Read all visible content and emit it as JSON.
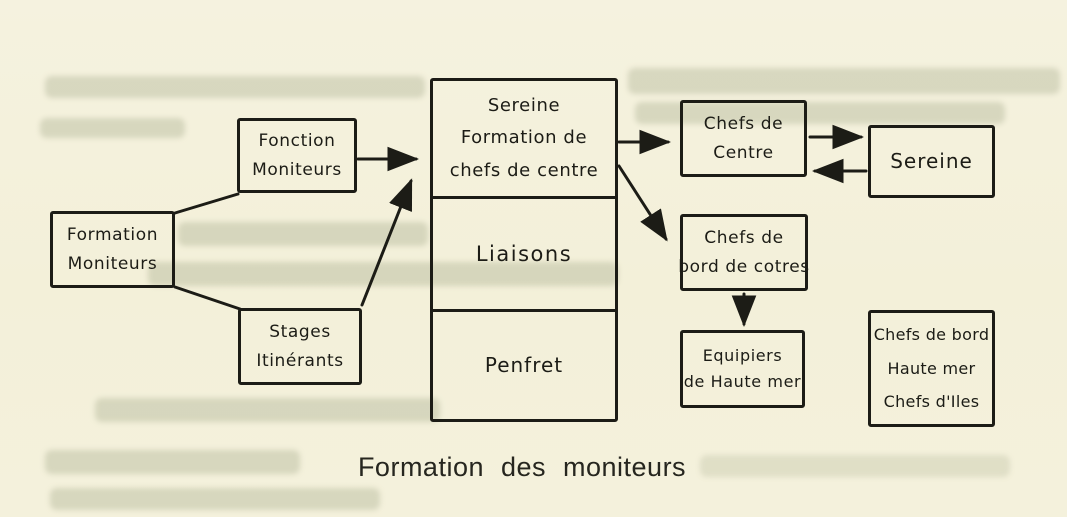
{
  "figure": {
    "caption": "Formation des moniteurs"
  },
  "boxes": {
    "fonction_moniteurs": {
      "lines": [
        "Fonction",
        "Moniteurs"
      ]
    },
    "formation_moniteurs": {
      "lines": [
        "Formation",
        "Moniteurs"
      ]
    },
    "stages_itinerants": {
      "lines": [
        "Stages",
        "Itinérants"
      ]
    },
    "central": {
      "sections": [
        {
          "name": "sereine-formation",
          "lines": [
            "Sereine",
            "Formation de",
            "chefs de centre"
          ]
        },
        {
          "name": "liaisons",
          "lines": [
            "Liaisons"
          ]
        },
        {
          "name": "penfret",
          "lines": [
            "Penfret"
          ]
        }
      ]
    },
    "chefs_de_centre": {
      "lines": [
        "Chefs de",
        "Centre"
      ]
    },
    "sereine": {
      "lines": [
        "Sereine"
      ]
    },
    "chefs_de_bord_de_cotres": {
      "lines": [
        "Chefs de",
        "bord de cotres"
      ]
    },
    "equipiers_de_haute_mer": {
      "lines": [
        "Equipiers",
        "de Haute mer"
      ]
    },
    "chefs_de_bord_haute_mer": {
      "lines": [
        "Chefs de bord",
        "Haute mer",
        "Chefs d'Iles"
      ]
    }
  },
  "connections": [
    {
      "from": "formation_moniteurs",
      "to": "fonction_moniteurs",
      "arrow": false
    },
    {
      "from": "formation_moniteurs",
      "to": "stages_itinerants",
      "arrow": false
    },
    {
      "from": "fonction_moniteurs",
      "to": "central",
      "arrow": true
    },
    {
      "from": "stages_itinerants",
      "to": "central",
      "arrow": true
    },
    {
      "from": "central",
      "to": "chefs_de_centre",
      "arrow": true
    },
    {
      "from": "central",
      "to": "chefs_de_bord_de_cotres",
      "arrow": true
    },
    {
      "from": "chefs_de_centre",
      "to": "sereine",
      "arrow": true
    },
    {
      "from": "sereine",
      "to": "chefs_de_centre",
      "arrow": true
    },
    {
      "from": "chefs_de_bord_de_cotres",
      "to": "equipiers_de_haute_mer",
      "arrow": true
    }
  ],
  "colors": {
    "paper": "#f4f1dc",
    "ink": "#1c1c16"
  }
}
